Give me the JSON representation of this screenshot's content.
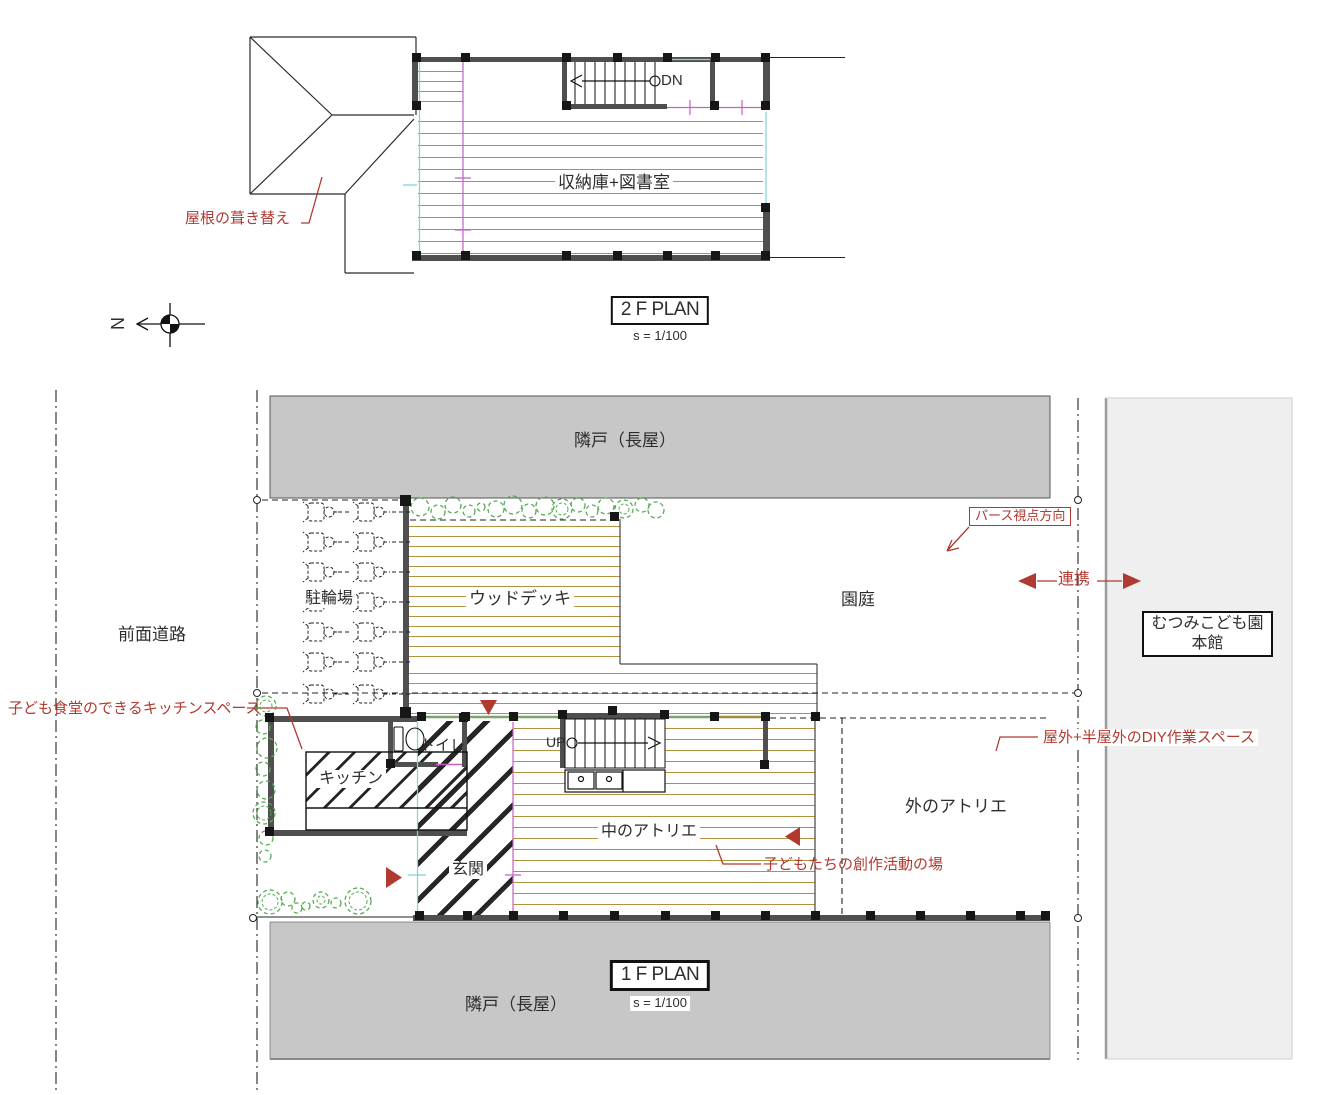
{
  "plans": {
    "plan2f_title": "2 F PLAN",
    "plan2f_scale": "s = 1/100",
    "plan1f_title": "1 F PLAN",
    "plan1f_scale": "s = 1/100"
  },
  "north": {
    "label": "N"
  },
  "floor2": {
    "storage_library": "収納庫+図書室",
    "down": "DN",
    "roof_note": "屋根の葺き替え"
  },
  "site": {
    "neighbor_top": "隣戸（長屋）",
    "neighbor_bottom": "隣戸（長屋）",
    "front_road": "前面道路",
    "bicycle_parking": "駐輪場",
    "wood_deck": "ウッドデッキ",
    "garden": "園庭",
    "honkan_line1": "むつみこども園",
    "honkan_line2": "本館"
  },
  "floor1": {
    "toilet": "トイレ",
    "kitchen": "キッチン",
    "entrance": "玄関",
    "atelier_inside": "中のアトリエ",
    "atelier_outside": "外のアトリエ",
    "up": "UP"
  },
  "annotations": {
    "perspective_direction": "パース視点方向",
    "link": "連携",
    "kitchen_space_note": "子ども食堂のできるキッチンスペース",
    "diy_space_note": "屋外+半屋外のDIY作業スペース",
    "creative_space_note": "子どもたちの創作活動の場"
  },
  "colors": {
    "annotation_red": "#b13a30",
    "wood_line": "#b3923f",
    "wall_gray": "#4f4f4f",
    "column_black": "#161616",
    "cyan_line": "#7fd4d4",
    "magenta_line": "#c75fc7",
    "bush_green": "#57ab57",
    "beam_green": "#7fa36b",
    "beam_tan": "#a08a40",
    "neighbor_gray": "#c7c7c7",
    "honkan_gray": "#efefef"
  }
}
